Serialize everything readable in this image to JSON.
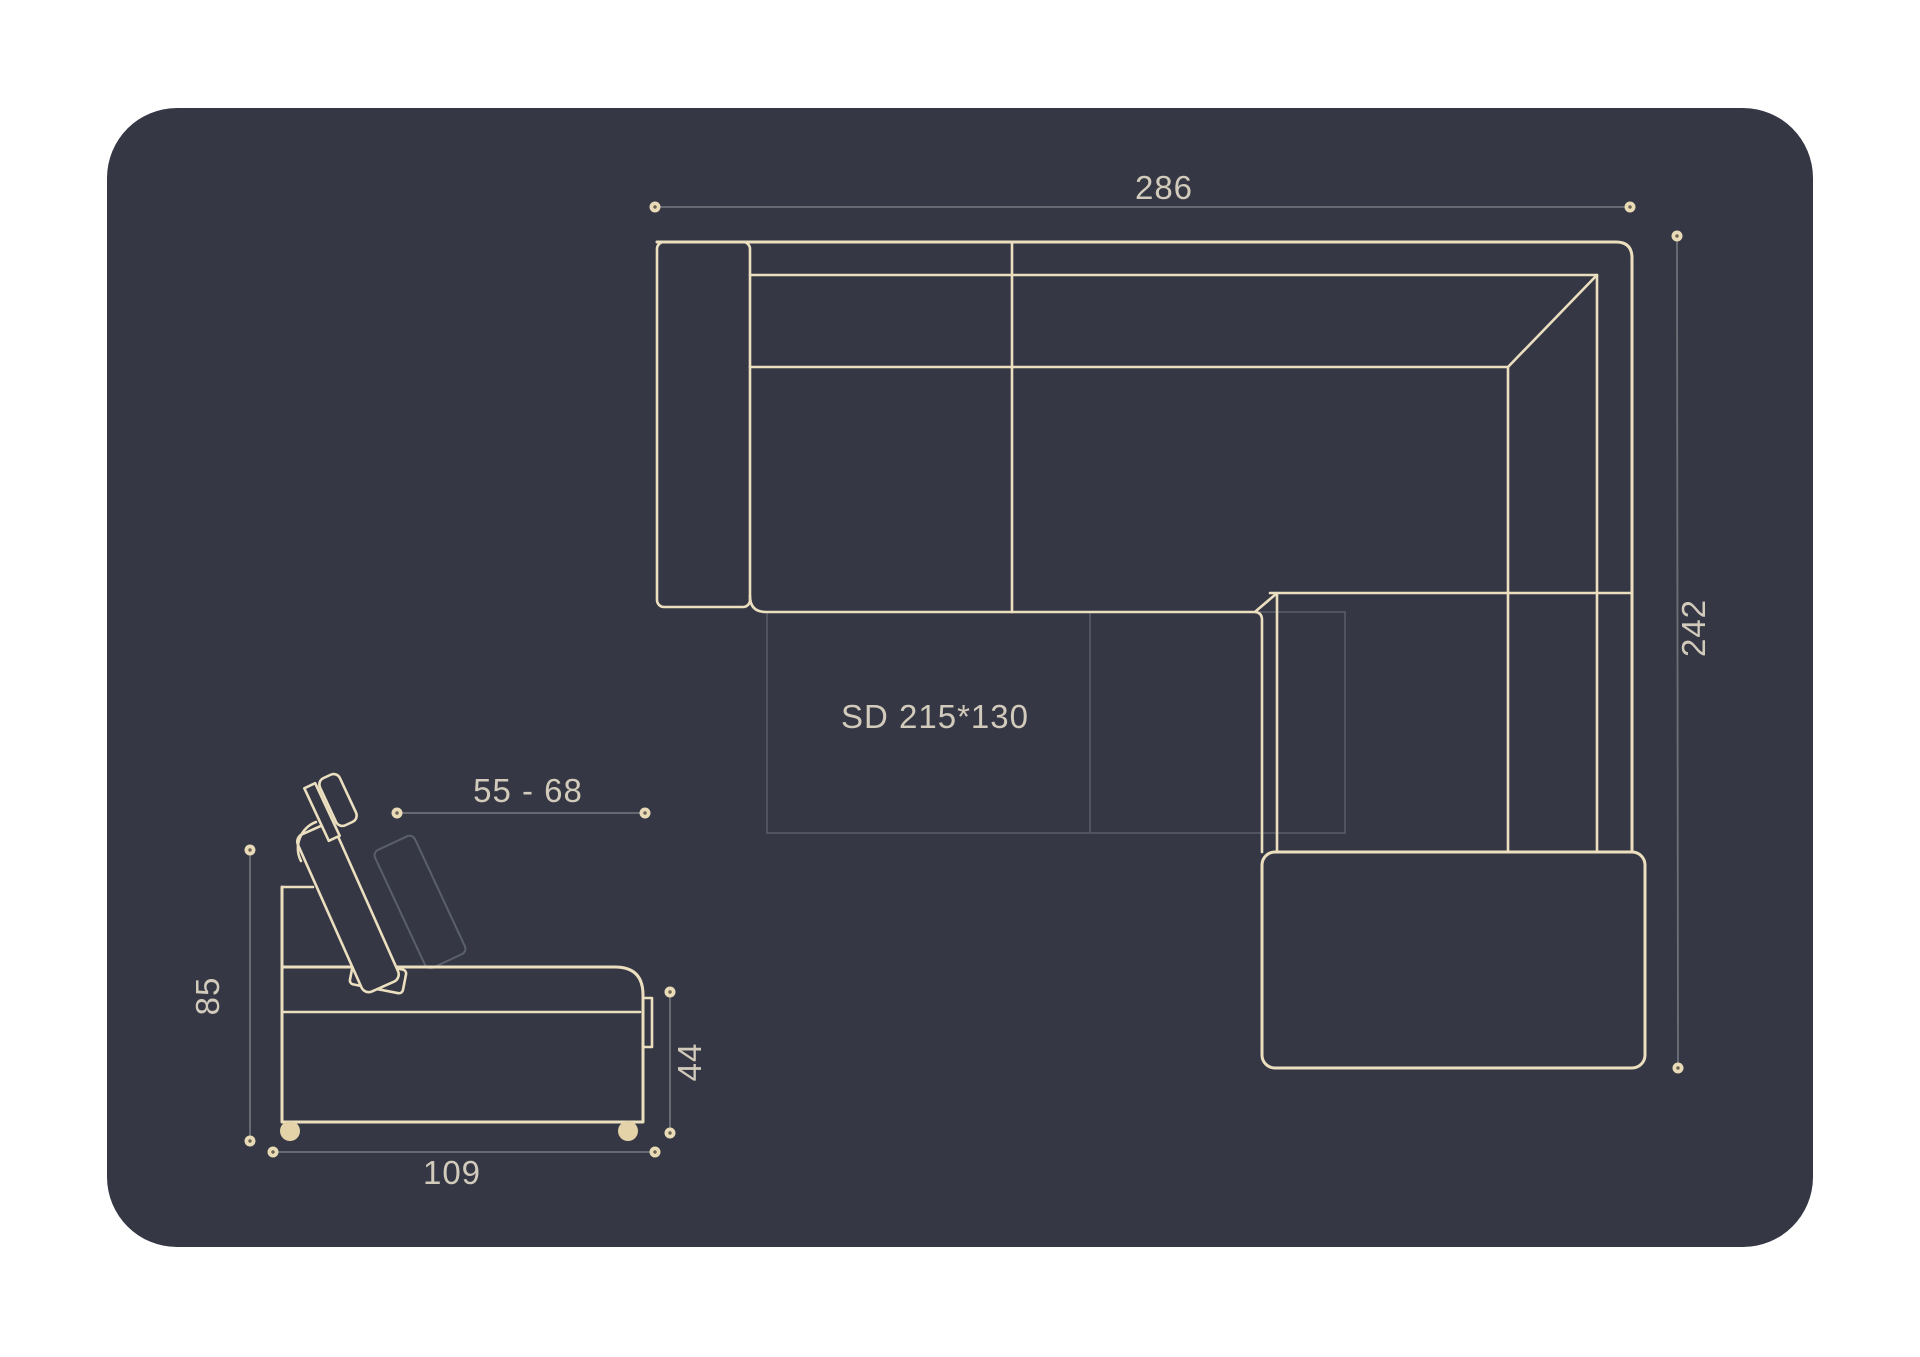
{
  "drawing": {
    "title": "corner-sofa-dimension-diagram",
    "labels": {
      "top_width": "286",
      "top_depth": "242",
      "sleeping_dimensions": "SD 215*130",
      "headrest_range": "55 - 68",
      "total_height": "85",
      "seat_height": "44",
      "side_depth": "109"
    },
    "colors": {
      "page_background": "#ffffff",
      "panel": "#353844",
      "outline": "#ecdfc0",
      "dimension_line": "#6e7078",
      "faint_line": "#565b68",
      "label_text": "#d2cbbc",
      "leg": "#e4d2a8"
    }
  }
}
